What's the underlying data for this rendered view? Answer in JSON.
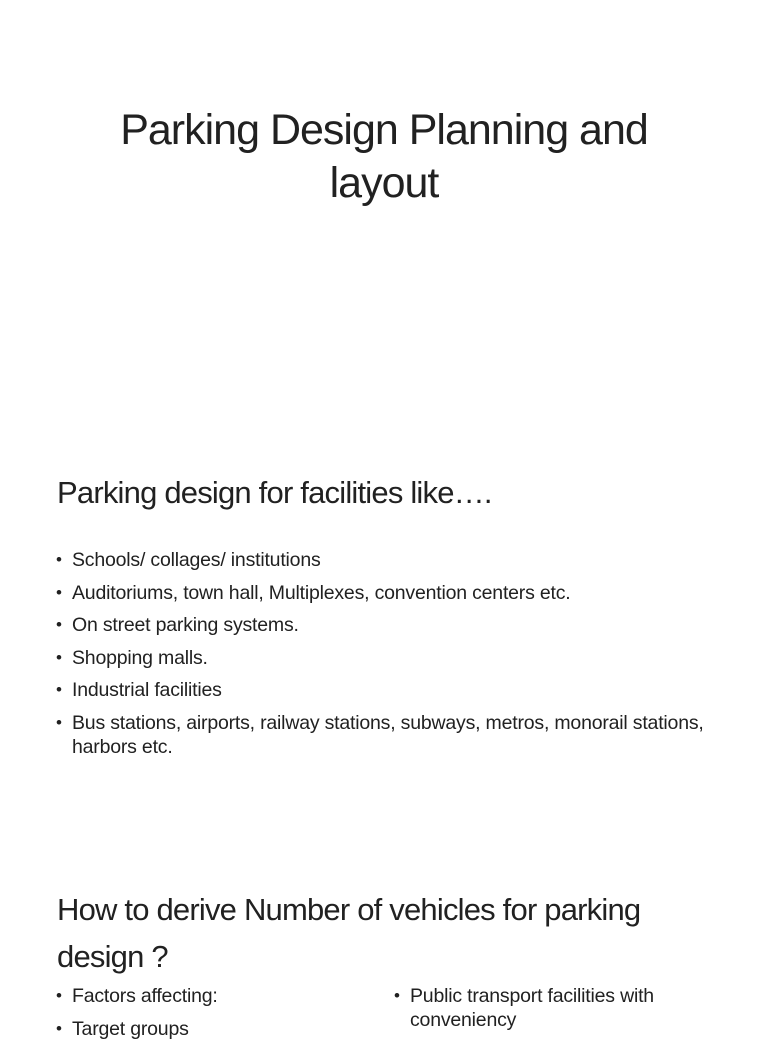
{
  "document": {
    "background_color": "#ffffff",
    "text_color": "#212121",
    "bullet_char": "•",
    "slides": [
      {
        "type": "title",
        "title": "Parking Design Planning and layout"
      },
      {
        "type": "content",
        "heading": "Parking design for facilities like….",
        "bullets": [
          "Schools/ collages/ institutions",
          "Auditoriums, town hall, Multiplexes, convention centers etc.",
          "On street parking systems.",
          "Shopping malls.",
          "Industrial facilities",
          "Bus stations, airports, railway stations, subways, metros, monorail stations, harbors etc."
        ]
      },
      {
        "type": "content-two-column",
        "heading": "How to derive Number of vehicles for parking design ?",
        "left_bullets": [
          "Factors affecting:",
          "Target groups"
        ],
        "right_bullets": [
          "Public transport facilities with conveniency"
        ]
      }
    ]
  }
}
